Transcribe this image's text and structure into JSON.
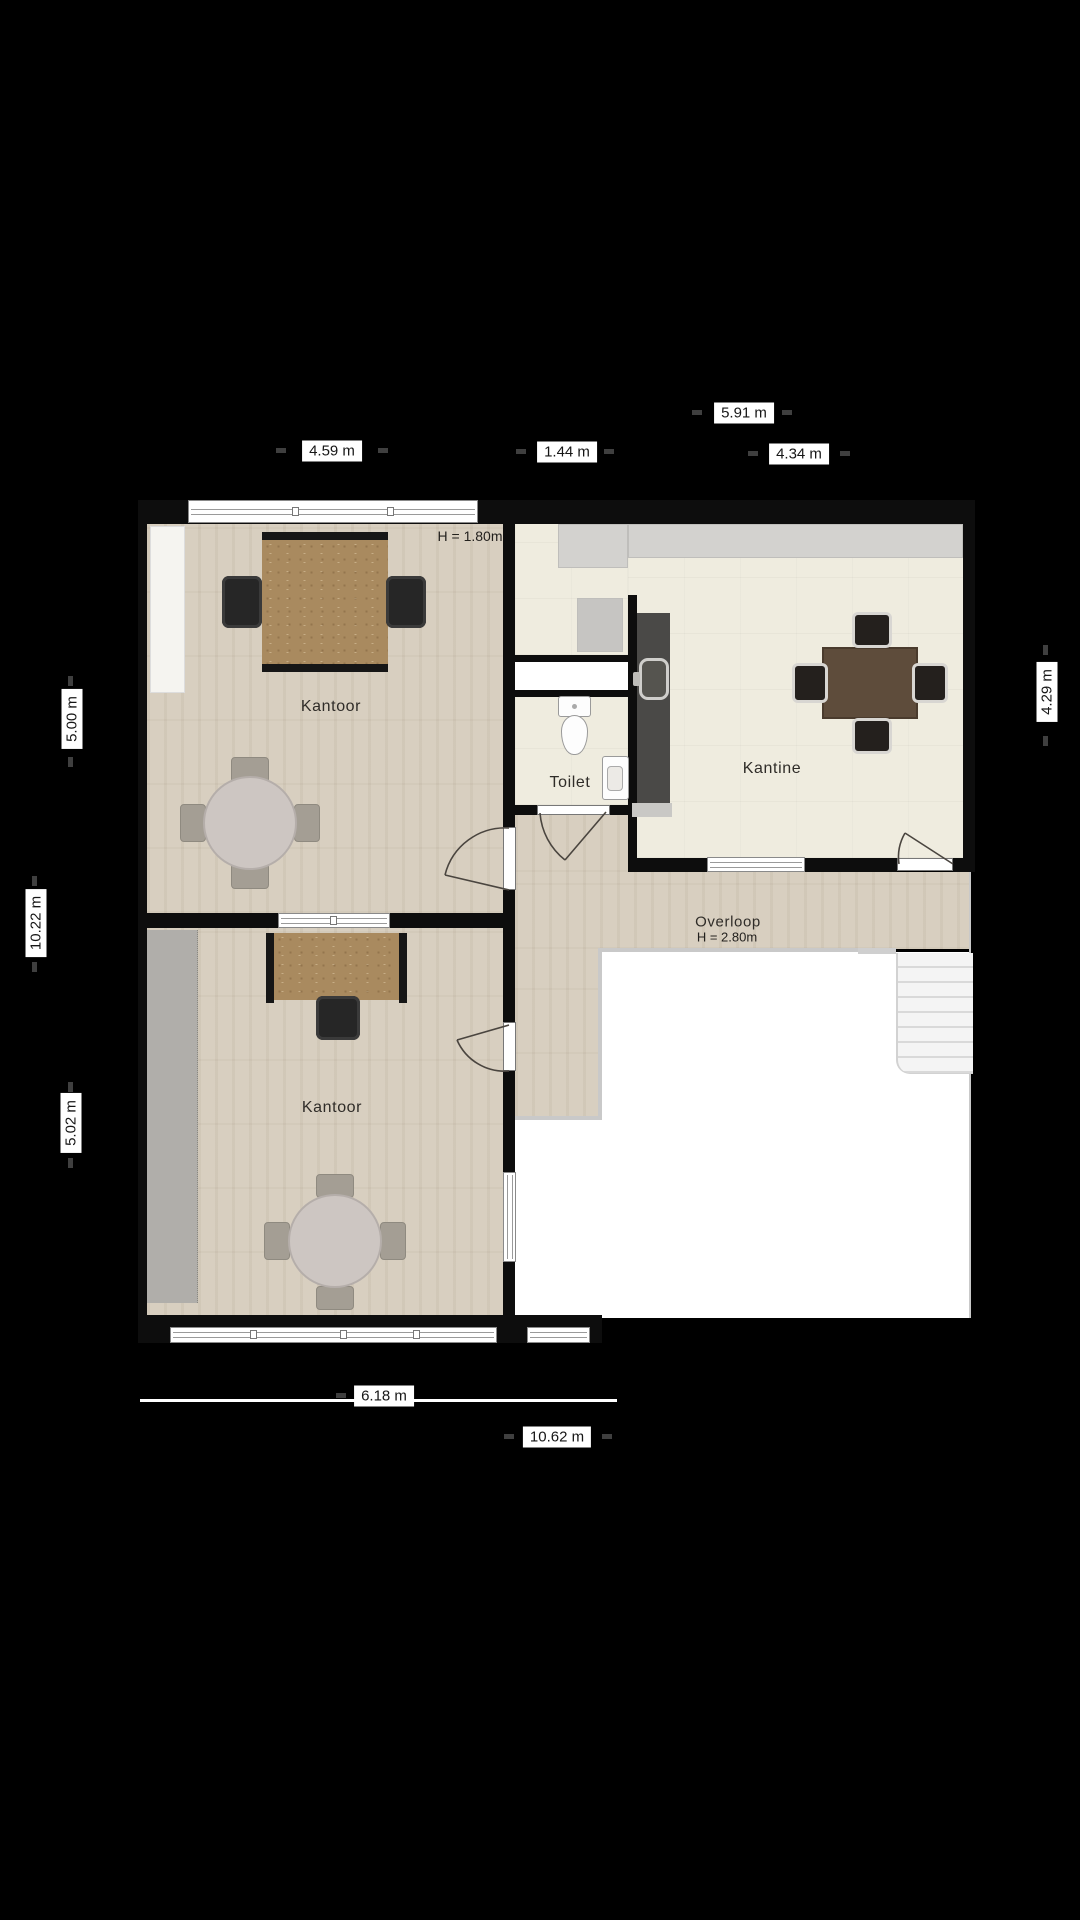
{
  "title": "Verdieping plattegrond",
  "rooms": {
    "kantoor_top": "Kantoor",
    "kantoor_bottom": "Kantoor",
    "kantine": "Kantine",
    "toilet": "Toilet",
    "overloop": "Overloop"
  },
  "heights": {
    "kantoor_top": "H = 1.80m",
    "overloop": "H = 2.80m"
  },
  "dimensions": {
    "top_kantoor_width": "4.59 m",
    "top_hall_width": "1.44 m",
    "top_kantine_outer": "5.91 m",
    "top_kantine_inner": "4.34 m",
    "left_upper_height": "5.00 m",
    "left_total_height": "10.22 m",
    "left_lower_height": "5.02 m",
    "right_kantine_height": "4.29 m",
    "bottom_left_width": "6.18 m",
    "bottom_total_width": "10.62 m"
  },
  "colors": {
    "background": "#000000",
    "wood_floor": "#d8cfc0",
    "tile_floor": "#efecdf",
    "wall": "#0d0d0d",
    "counter": "#4a4947",
    "desk_wood": "#a98a5f",
    "dining_table": "#5e4c3b",
    "void": "#ffffff"
  }
}
